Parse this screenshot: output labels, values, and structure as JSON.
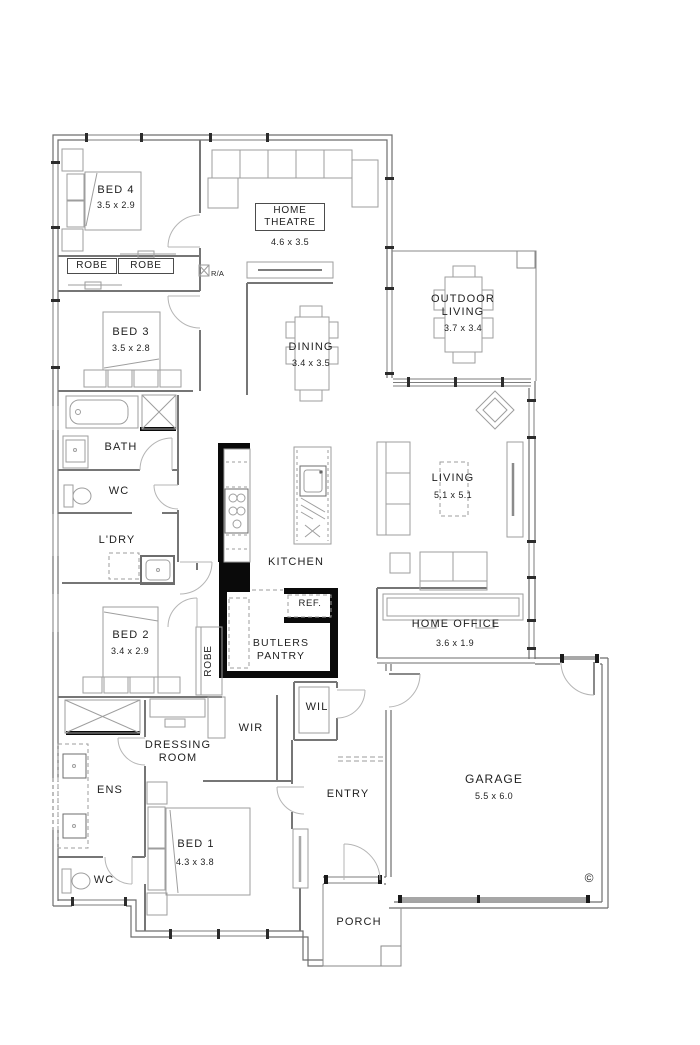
{
  "plan": {
    "rooms": {
      "bed4": {
        "name": "BED 4",
        "dims": "3.5 x 2.9"
      },
      "home_theatre": {
        "name": "HOME THEATRE",
        "dims": "4.6 x 3.5"
      },
      "robe_left": {
        "name": "ROBE"
      },
      "robe_right": {
        "name": "ROBE"
      },
      "return_air": {
        "name": "R/A"
      },
      "bed3": {
        "name": "BED 3",
        "dims": "3.5 x 2.8"
      },
      "outdoor_living": {
        "name": "OUTDOOR LIVING",
        "dims": "3.7 x 3.4"
      },
      "dining": {
        "name": "DINING",
        "dims": "3.4 x 3.5"
      },
      "bath": {
        "name": "BATH"
      },
      "wc_main": {
        "name": "WC"
      },
      "laundry": {
        "name": "L'DRY"
      },
      "kitchen": {
        "name": "KITCHEN"
      },
      "living": {
        "name": "LIVING",
        "dims": "5.1 x 5.1"
      },
      "fridge": {
        "name": "REF."
      },
      "bed2": {
        "name": "BED 2",
        "dims": "3.4 x 2.9"
      },
      "robe_bed2": {
        "name": "ROBE"
      },
      "butlers_pantry": {
        "name": "BUTLERS PANTRY"
      },
      "home_office": {
        "name": "HOME OFFICE",
        "dims": "3.6 x 1.9"
      },
      "wir": {
        "name": "WIR"
      },
      "wil": {
        "name": "WIL"
      },
      "dressing_room": {
        "name": "DRESSING ROOM"
      },
      "ens": {
        "name": "ENS"
      },
      "entry": {
        "name": "ENTRY"
      },
      "bed1": {
        "name": "BED 1",
        "dims": "4.3 x 3.8"
      },
      "wc_ens": {
        "name": "WC"
      },
      "garage": {
        "name": "GARAGE",
        "dims": "5.5 x 6.0"
      },
      "porch": {
        "name": "PORCH"
      }
    },
    "copyright_mark": "©",
    "colors": {
      "wall": "#6e6e6e",
      "black_wall": "#0a0a0a",
      "furniture": "#9e9e9e",
      "text": "#1f1f1f"
    }
  }
}
